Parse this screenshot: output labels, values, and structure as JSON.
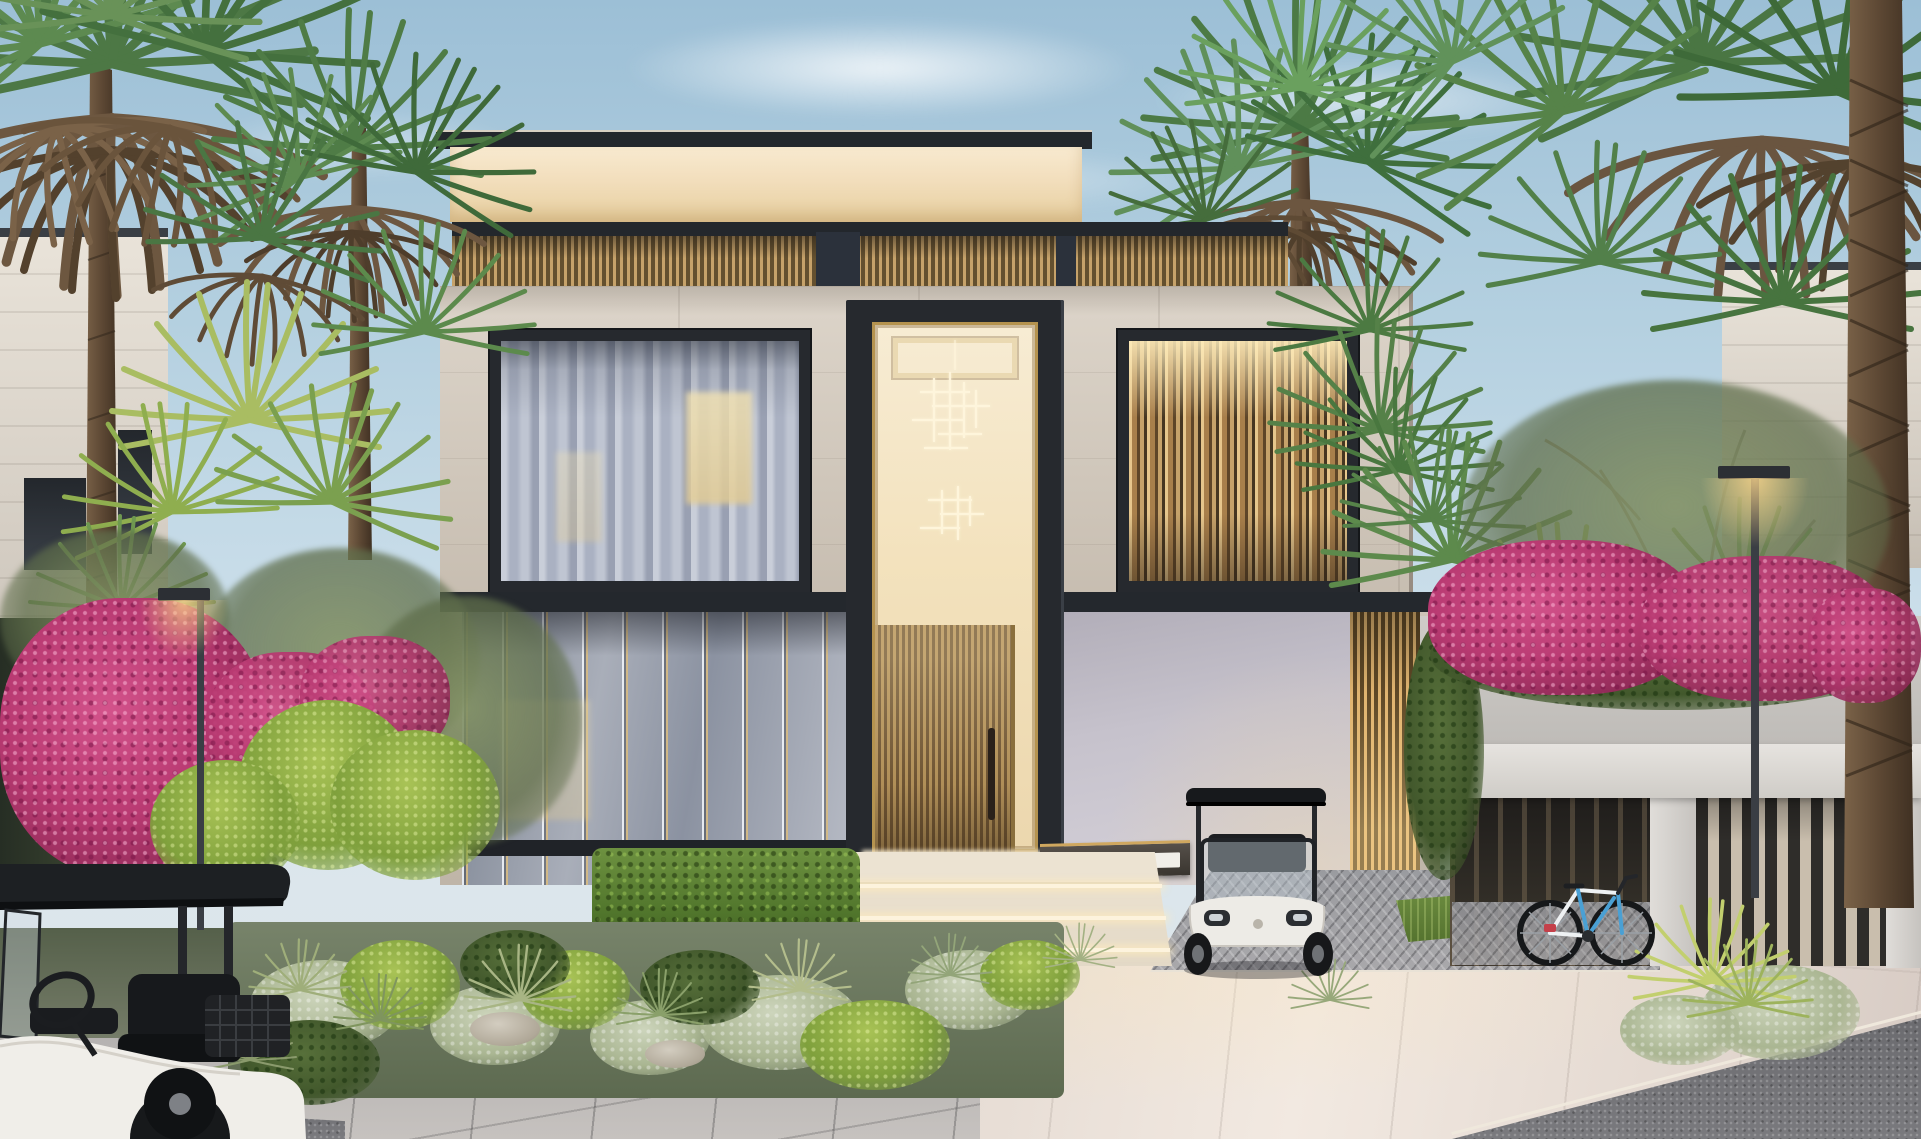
{
  "scene": {
    "description": "Dusk front elevation of a modern two-storey luxury villa with warm cove lighting, a tall glass entry portal with chandelier, wooden slat door, curtained and louvered windows, flanked by palm trees and pink bougainvillea; a white golf cart is parked by the entrance, another golf cart sits in the left foreground, and a bicycle leans on the dark slat gate at right beside a paved driveway",
    "sign": {
      "label": "VILLA",
      "number_plate": ""
    }
  },
  "palette": {
    "sky_top": "#9cbfd6",
    "sky_mid": "#c9dde9",
    "sky_low": "#e1e7e9",
    "stone": "#cfc6ba",
    "frame_dark": "#26292e",
    "brass": "#b5934f",
    "glow_warm": "#e7cf9f",
    "interior_warm": "#f3e2bd",
    "curtain": "#aab1c2",
    "wood_slat": "#c6a26a",
    "gold_slat": "#e0b470",
    "stucco": "#c6c2cc",
    "white_wall": "#bdbab6",
    "driveway_light": "#f2e9e1",
    "paver_gray": "#c6c2bf",
    "cobble_gray": "#a9a8ab",
    "granite_dark": "#7a7a7e",
    "hedge_green": "#51762c",
    "leaf_bright": "#7fa03c",
    "sage_green": "#aab692",
    "bougainvillea_pink": "#b93a72",
    "palm_green": "#4d7845",
    "palm_dry_brown": "#6d5740",
    "trunk_brown": "#5d4834",
    "canopy_dark": "#1d2023",
    "cart_white": "#edebe6",
    "bike_blue": "#4aa0d4",
    "turf_green": "#55732f"
  }
}
